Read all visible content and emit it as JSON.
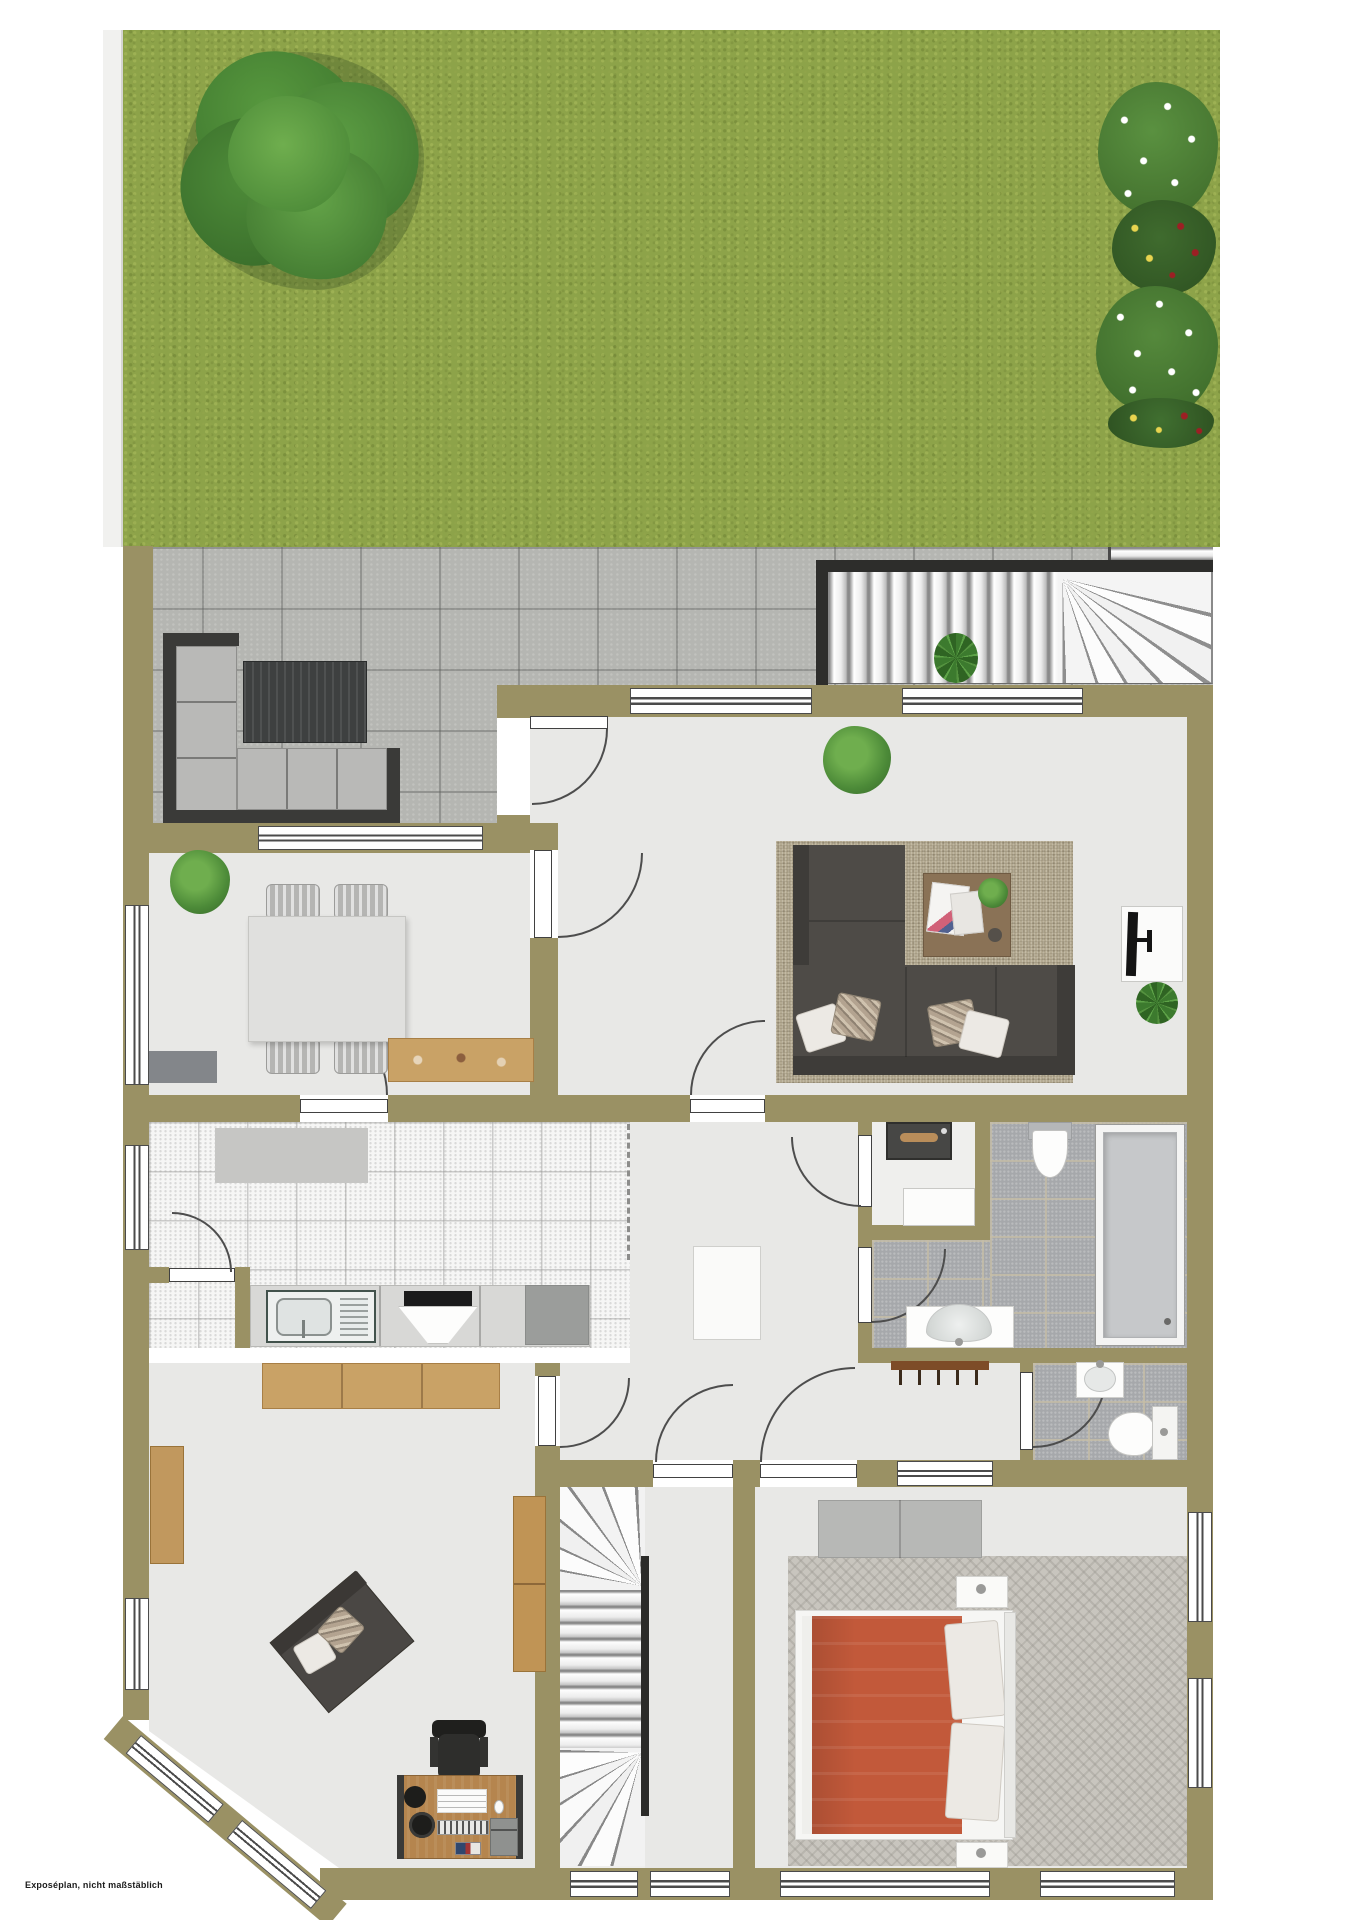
{
  "caption": "Exposéplan, nicht maßstäblich",
  "plan": {
    "type": "floor-plan-rendering",
    "view": "top-down ground floor with garden",
    "palette": {
      "wall": "#9a9164",
      "grass": "#8da349",
      "paver": "#b5b6b2",
      "interior_floor": "#e8e8e6",
      "kitchen_tile": "#f6f6f5",
      "bathroom_tile": "#a6a8ab",
      "living_rug": "#b4aa92",
      "sofa_dark": "#4e4b47",
      "bed_duvet": "#c2593a",
      "wood_light": "#c9a266",
      "desk_wood": "#b5854e",
      "stair_tread": "#f2f2f2",
      "door_line": "#4d4d4d",
      "outdoor_cushion": "#b9b9b7",
      "tree_green": "#4c8a38"
    },
    "outdoor": {
      "garden": {
        "surface": "lawn",
        "elements": [
          "large-tree",
          "flower-bed-white-red-yellow",
          "boundary-strip"
        ]
      },
      "patio": {
        "surface": "concrete-pavers",
        "elements": [
          "outdoor-corner-sofa",
          "outdoor-coffee-table",
          "potted-plant"
        ]
      },
      "exterior_staircase": {
        "shape": "straight run with winder turn",
        "treads": 16
      }
    },
    "rooms": [
      {
        "name": "living-room",
        "floor": "light-gray",
        "furniture": [
          "area-rug",
          "corner-sofa",
          "throw-pillows-4",
          "coffee-table",
          "magazines",
          "tv-lowboard",
          "tv",
          "potted-plant",
          "plant-by-tv"
        ],
        "openings": [
          "terrace-door",
          "north-window-1",
          "north-window-2",
          "door-to-dining",
          "door-to-hall"
        ]
      },
      {
        "name": "dining-room",
        "floor": "light-gray",
        "furniture": [
          "dining-table",
          "chairs-4",
          "sideboard",
          "doormat",
          "potted-plant"
        ],
        "openings": [
          "north-window",
          "west-window",
          "door-to-kitchen"
        ]
      },
      {
        "name": "kitchen",
        "floor": "white-tile",
        "furniture": [
          "kitchen-mat",
          "counter",
          "sink-unit",
          "cooktop-with-hood",
          "tall-appliance"
        ],
        "openings": [
          "west-window",
          "open-passage-to-hall",
          "pantry-door"
        ]
      },
      {
        "name": "pantry-nook",
        "floor": "white-tile",
        "furniture": []
      },
      {
        "name": "hallway",
        "floor": "light-gray",
        "furniture": [
          "coat-rack",
          "cabinet"
        ],
        "openings": [
          "door-to-living",
          "door-to-utility",
          "door-to-bathroom",
          "door-to-wc",
          "door-to-office",
          "door-to-stairwell",
          "door-to-bedroom",
          "bedroom-second-opening"
        ]
      },
      {
        "name": "utility-room",
        "floor": "light",
        "furniture": [
          "stove-unit",
          "cabinet"
        ]
      },
      {
        "name": "bathroom",
        "floor": "gray-tile",
        "furniture": [
          "shower-tray",
          "wall-hung-toilet",
          "vanity-washbasin"
        ]
      },
      {
        "name": "wc",
        "floor": "gray-tile",
        "furniture": [
          "washbasin",
          "toilet-with-cistern"
        ]
      },
      {
        "name": "bedroom",
        "floor": "light-gray + carpet",
        "furniture": [
          "double-bed-orange-duvet",
          "pillows-2",
          "headboard",
          "nightstand-2",
          "wardrobe"
        ],
        "openings": [
          "east-window-1",
          "east-window-2",
          "south-window"
        ]
      },
      {
        "name": "office",
        "floor": "light-gray",
        "furniture": [
          "desk",
          "office-chair",
          "desk-lamp",
          "printer",
          "keyboard",
          "loveseat",
          "bookshelf",
          "tall-shelf",
          "sideboard"
        ],
        "openings": [
          "bay-corner-windows",
          "west-window"
        ]
      },
      {
        "name": "stairwell",
        "floor": "light",
        "furniture": [
          "interior-winder-staircase",
          "handrail",
          "landing"
        ],
        "openings": [
          "south-window"
        ]
      }
    ]
  }
}
